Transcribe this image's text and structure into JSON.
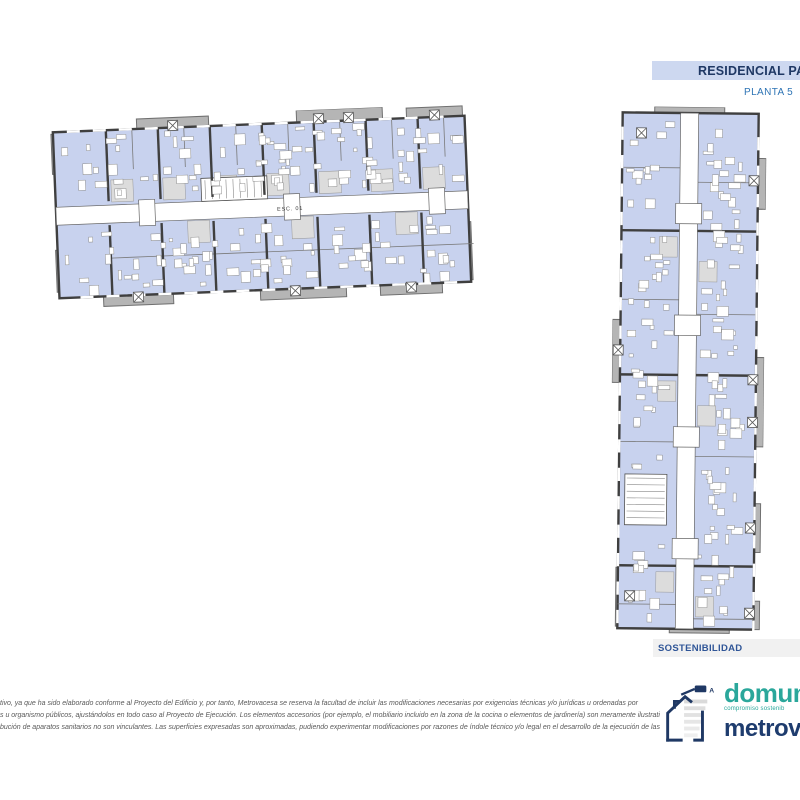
{
  "header": {
    "title": "RESIDENCIAL PA",
    "subtitle": "PLANTA 5",
    "band_color": "#cdd8f0",
    "title_color": "#1f3864",
    "subtitle_color": "#2e74b5"
  },
  "plans": {
    "horizontal": {
      "core_label": "ESC. 01"
    },
    "vertical": {}
  },
  "sustainability": {
    "label": "SOSTENIBILIDAD",
    "label_color": "#2f5597",
    "band_color": "#f1f1f1"
  },
  "disclaimer": {
    "lines": [
      "tivo, ya que ha sido elaborado conforme al Proyecto del Edificio y, por tanto, Metrovacesa se reserva la facultad de incluir las modificaciones necesarias por exigencias técnicas y/o jurídicas u ordenadas por",
      "s u organismo públicos, ajustándolos en todo caso al Proyecto de Ejecución. Los elementos accesorios (por ejemplo, el mobiliario incluido en la zona de la cocina o elementos de jardinería) son meramente ilustrativos.",
      "bución de aparatos sanitarios no son vinculantes. Las superficies expresadas son aproximadas, pudiendo experimentar modificaciones por razones de índole técnico y/o legal en el desarrollo de la ejecución de las"
    ]
  },
  "branding": {
    "domum_text": "domum",
    "domum_tagline": "compromiso sostenib",
    "metrovacesa_text": "metrov",
    "energy_label": "A",
    "domum_color": "#2aa79b",
    "metrovacesa_color": "#1e3c6e",
    "icon_color": "#1f3864"
  },
  "colors": {
    "room": "#c8d2ee",
    "wall": "#3f3f3f",
    "balcony": "#b5b5b5",
    "balcony_edge": "#707070",
    "corridor": "#ffffff",
    "furniture": "#8f8f8f",
    "partition": "#7a7a7a",
    "bath": "#dcdcdc"
  }
}
